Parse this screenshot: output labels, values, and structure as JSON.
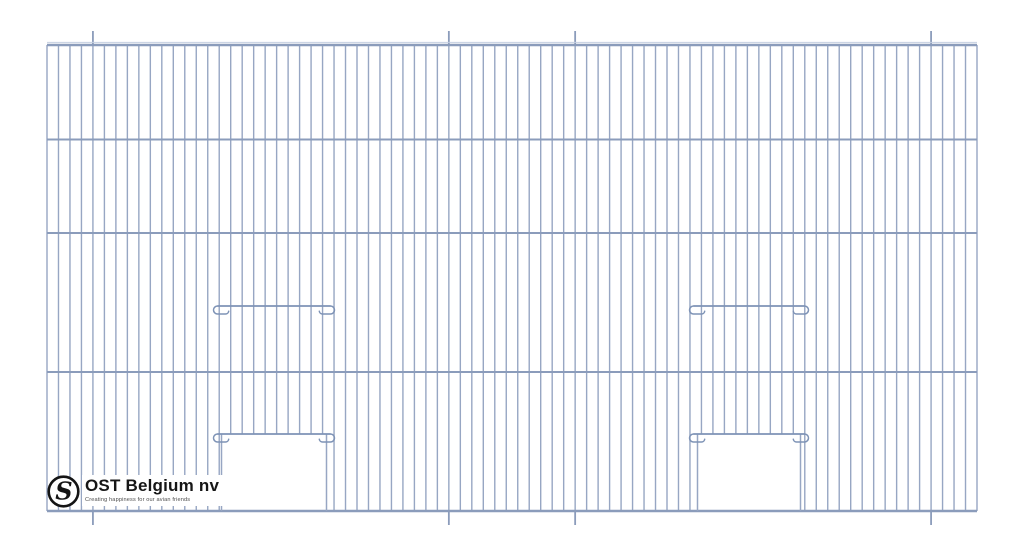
{
  "page": {
    "background": "#ffffff"
  },
  "logo": {
    "monogram": "S",
    "brand": "OST Belgium nv",
    "tagline": "Creating happiness for our avian friends",
    "ring_color": "#141414",
    "text_color": "#161616",
    "tagline_color": "#4d4d4d"
  },
  "drawing": {
    "description": "Technical front-view drawing of a wire cage front panel with two vertical-slide doors",
    "colors": {
      "wire": "#97a6c3",
      "rail": "#8b9cbb",
      "rail_highlight": "#c5cfe1",
      "door_bar": "#7e93b6"
    },
    "frame": {
      "left": 47,
      "right": 977,
      "top": 45,
      "bottom": 511
    },
    "vertical_wires": {
      "count": 82,
      "spacing": 11.4815,
      "stroke_width": 1.4
    },
    "rails_y": [
      45,
      139.5,
      233,
      372,
      511
    ],
    "extended_wire_indices": [
      4,
      35,
      46,
      77
    ],
    "extension_length": 14,
    "doors": [
      {
        "id": "left",
        "x1": 221.5,
        "x2": 326.5,
        "upper_bar_y": 306,
        "lower_bar_y": 434,
        "opening_bottom": 511,
        "bar_overhang": 8
      },
      {
        "id": "right",
        "x1": 697.5,
        "x2": 800.5,
        "upper_bar_y": 306,
        "lower_bar_y": 434,
        "opening_bottom": 511,
        "bar_overhang": 8
      }
    ]
  }
}
